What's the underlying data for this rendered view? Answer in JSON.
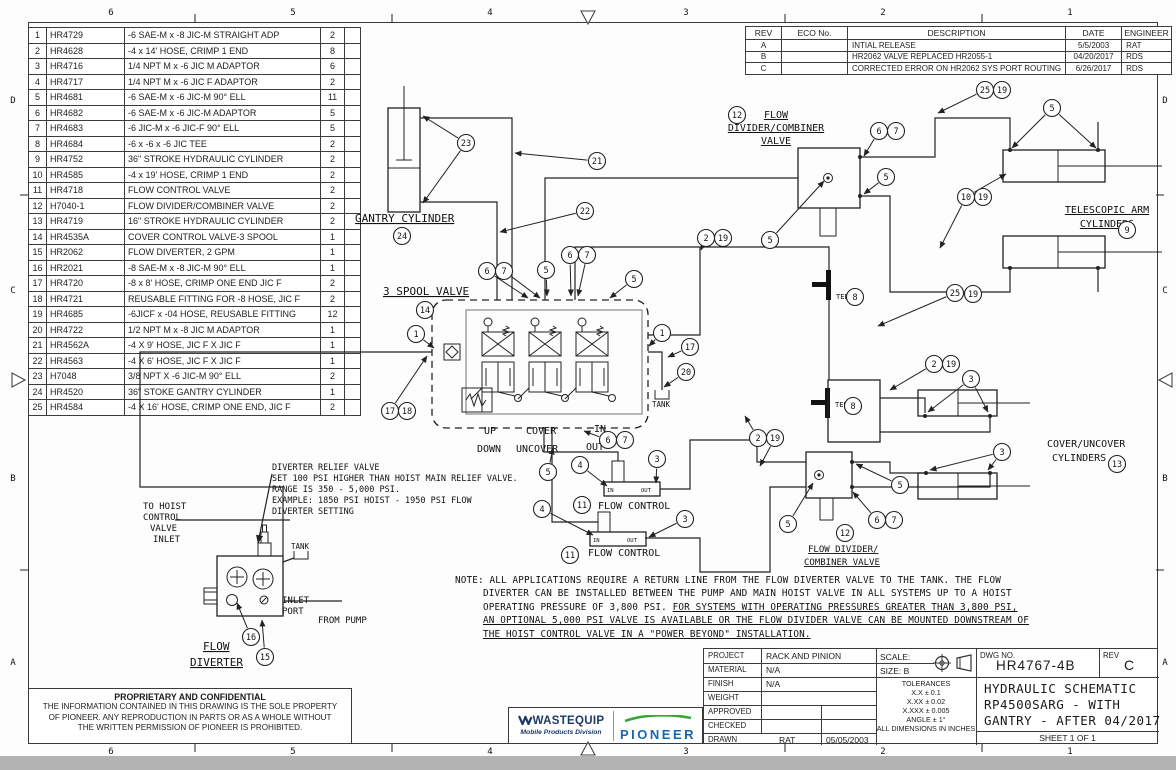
{
  "sheet": {
    "zones_top": [
      "6",
      "5",
      "4",
      "3",
      "2",
      "1"
    ],
    "zones_bottom": [
      "6",
      "5",
      "4",
      "3",
      "2",
      "1"
    ],
    "zones_left": [
      "D",
      "C",
      "B",
      "A"
    ],
    "zones_right": [
      "D",
      "C",
      "B",
      "A"
    ]
  },
  "parts_list": {
    "rows": [
      [
        "1",
        "HR4729",
        "-6 SAE-M x -8 JIC-M STRAIGHT ADP",
        "2"
      ],
      [
        "2",
        "HR4628",
        "-4 x 14' HOSE, CRIMP 1 END",
        "8"
      ],
      [
        "3",
        "HR4716",
        "1/4 NPT M x -6 JIC M ADAPTOR",
        "6"
      ],
      [
        "4",
        "HR4717",
        "1/4 NPT M x -6 JIC F ADAPTOR",
        "2"
      ],
      [
        "5",
        "HR4681",
        "-6 SAE-M x -6 JIC-M 90° ELL",
        "11"
      ],
      [
        "6",
        "HR4682",
        "-6 SAE-M x -6 JIC-M ADAPTOR",
        "5"
      ],
      [
        "7",
        "HR4683",
        "-6 JIC-M x -6 JIC-F 90° ELL",
        "5"
      ],
      [
        "8",
        "HR4684",
        "-6 x -6 x -6 JIC TEE",
        "2"
      ],
      [
        "9",
        "HR4752",
        "36\" STROKE HYDRAULIC CYLINDER",
        "2"
      ],
      [
        "10",
        "HR4585",
        "-4 x 19' HOSE, CRIMP 1 END",
        "2"
      ],
      [
        "11",
        "HR4718",
        "FLOW CONTROL VALVE",
        "2"
      ],
      [
        "12",
        "H7040-1",
        "FLOW DIVIDER/COMBINER VALVE",
        "2"
      ],
      [
        "13",
        "HR4719",
        "16\" STROKE HYDRAULIC CYLINDER",
        "2"
      ],
      [
        "14",
        "HR4535A",
        "COVER CONTROL VALVE-3 SPOOL",
        "1"
      ],
      [
        "15",
        "HR2062",
        "FLOW DIVERTER, 2 GPM",
        "1"
      ],
      [
        "16",
        "HR2021",
        "-8 SAE-M x -8 JIC-M 90° ELL",
        "1"
      ],
      [
        "17",
        "HR4720",
        "-8 x 8' HOSE, CRIMP ONE END JIC F",
        "2"
      ],
      [
        "18",
        "HR4721",
        "REUSABLE FITTING FOR -8 HOSE, JIC F",
        "2"
      ],
      [
        "19",
        "HR4685",
        "-6JICF x -04 HOSE, REUSABLE FITTING",
        "12"
      ],
      [
        "20",
        "HR4722",
        "1/2 NPT M x -8 JIC M ADAPTOR",
        "1"
      ],
      [
        "21",
        "HR4562A",
        "-4 X 9' HOSE, JIC F X JIC F",
        "1"
      ],
      [
        "22",
        "HR4563",
        "-4 X 6' HOSE, JIC F X JIC F",
        "1"
      ],
      [
        "23",
        "H7048",
        "3/8 NPT X -6 JIC-M 90° ELL",
        "2"
      ],
      [
        "24",
        "HR4520",
        "36\" STOKE GANTRY CYLINDER",
        "1"
      ],
      [
        "25",
        "HR4584",
        "-4 X 16' HOSE, CRIMP ONE END, JIC F",
        "2"
      ]
    ]
  },
  "revisions": {
    "headers": [
      "REV",
      "ECO No.",
      "DESCRIPTION",
      "DATE",
      "ENGINEER"
    ],
    "rows": [
      [
        "A",
        "",
        "INTIAL RELEASE",
        "5/5/2003",
        "RAT"
      ],
      [
        "B",
        "",
        "HR2062 VALVE REPLACED HR2055-1",
        "04/20/2017",
        "RDS"
      ],
      [
        "C",
        "",
        "CORRECTED ERROR ON HR2062 SYS PORT ROUTING",
        "6/26/2017",
        "RDS"
      ]
    ]
  },
  "title_block": {
    "project_label": "PROJECT",
    "project": "RACK AND PINION",
    "material_label": "MATERIAL",
    "material": "N/A",
    "finish_label": "FINISH",
    "finish": "N/A",
    "weight_label": "WEIGHT",
    "weight": "",
    "approved_label": "APPROVED",
    "approved": "",
    "checked_label": "CHECKED",
    "checked": "",
    "drawn_label": "DRAWN",
    "drawn": "RAT",
    "drawn_date": "05/05/2003",
    "scale": "SCALE:",
    "size": "SIZE: B",
    "tolerances": [
      "TOLERANCES",
      "X.X ± 0.1",
      "X.XX ± 0.02",
      "X.XXX ± 0.005",
      "ANGLE ± 1°",
      "ALL DIMENSIONS IN INCHES"
    ],
    "dwg_no_label": "DWG NO.",
    "dwg_no": "HR4767-4B",
    "rev_label": "REV",
    "rev": "C",
    "title_line1": "HYDRAULIC SCHEMATIC",
    "title_line2": "RP4500SARG - WITH",
    "title_line3": "GANTRY - AFTER 04/2017",
    "sheet": "SHEET 1  OF 1"
  },
  "proprietary": {
    "heading": "PROPRIETARY AND CONFIDENTIAL",
    "line1": "THE INFORMATION CONTAINED IN THIS DRAWING IS THE SOLE PROPERTY",
    "line2": "OF PIONEER.  ANY REPRODUCTION IN PARTS OR AS A WHOLE WITHOUT",
    "line3": "THE WRITTEN PERMISSION OF PIONEER IS PROHIBITED."
  },
  "logos": {
    "wastequip": "WASTEQUIP",
    "division": "Mobile Products Division",
    "pioneer": "PIONEER",
    "navy": "#1b3a66",
    "blue": "#1667b2",
    "green": "#3aa63a"
  },
  "note": {
    "line1": "NOTE:    ALL APPLICATIONS REQUIRE A RETURN LINE FROM THE FLOW DIVERTER VALVE TO THE TANK. THE FLOW",
    "line2": "DIVERTER CAN BE INSTALLED BETWEEN THE PUMP AND MAIN HOIST VALVE IN ALL SYSTEMS UP TO A HOIST",
    "line3a": "OPERATING PRESSURE OF 3,800 PSI. ",
    "line3b": "FOR SYSTEMS WITH OPERATING PRESSURES GREATER THAN 3,800 PSI,",
    "line4": "AN OPTIONAL 5,000 PSI VALVE IS AVAILABLE OR THE FLOW DIVIDER VALVE CAN BE MOUNTED DOWNSTREAM OF",
    "line5": "THE HOIST CONTROL VALVE IN A \"POWER BEYOND\" INSTALLATION."
  },
  "schematic": {
    "labels": [
      {
        "text": "GANTRY CYLINDER",
        "x": 355,
        "y": 222,
        "s": 11,
        "u": true
      },
      {
        "text": "3 SPOOL VALVE",
        "x": 383,
        "y": 295,
        "s": 11,
        "u": true
      },
      {
        "text": "FLOW",
        "x": 776,
        "y": 118,
        "s": 10,
        "a": "middle",
        "u": true
      },
      {
        "text": "DIVIDER/COMBINER",
        "x": 776,
        "y": 131,
        "s": 10,
        "a": "middle",
        "u": true
      },
      {
        "text": "VALVE",
        "x": 776,
        "y": 144,
        "s": 10,
        "a": "middle",
        "u": true
      },
      {
        "text": "TELESCOPIC ARM",
        "x": 1107,
        "y": 213,
        "s": 10,
        "a": "middle",
        "u": true
      },
      {
        "text": "CYLINDERS",
        "x": 1107,
        "y": 227,
        "s": 10,
        "a": "middle",
        "u": true
      },
      {
        "text": "COVER/UNCOVER",
        "x": 1047,
        "y": 447,
        "s": 10
      },
      {
        "text": "CYLINDERS",
        "x": 1052,
        "y": 461,
        "s": 10
      },
      {
        "text": "FLOW DIVIDER/",
        "x": 808,
        "y": 552,
        "s": 9,
        "u": true
      },
      {
        "text": "COMBINER VALVE",
        "x": 804,
        "y": 565,
        "s": 9,
        "u": true
      },
      {
        "text": "FLOW CONTROL",
        "x": 598,
        "y": 509,
        "s": 10
      },
      {
        "text": "FLOW CONTROL",
        "x": 588,
        "y": 556,
        "s": 10
      },
      {
        "text": "UP",
        "x": 484,
        "y": 434,
        "s": 10
      },
      {
        "text": "DOWN",
        "x": 477,
        "y": 452,
        "s": 10
      },
      {
        "text": "COVER",
        "x": 526,
        "y": 434,
        "s": 10
      },
      {
        "text": "UNCOVER",
        "x": 516,
        "y": 452,
        "s": 10
      },
      {
        "text": "IN",
        "x": 594,
        "y": 432,
        "s": 10
      },
      {
        "text": "OUT",
        "x": 586,
        "y": 450,
        "s": 10
      },
      {
        "text": "TANK",
        "x": 652,
        "y": 407,
        "s": 7.5
      },
      {
        "text": "TANK",
        "x": 291,
        "y": 549,
        "s": 7.5
      },
      {
        "text": "TEE",
        "x": 836,
        "y": 299,
        "s": 7
      },
      {
        "text": "TEE",
        "x": 835,
        "y": 407,
        "s": 7
      },
      {
        "text": "TO HOIST",
        "x": 143,
        "y": 509,
        "s": 9
      },
      {
        "text": "CONTROL",
        "x": 143,
        "y": 520,
        "s": 9
      },
      {
        "text": "VALVE",
        "x": 150,
        "y": 531,
        "s": 9
      },
      {
        "text": "INLET",
        "x": 153,
        "y": 542,
        "s": 9
      },
      {
        "text": "DIVERTER RELIEF VALVE",
        "x": 272,
        "y": 470,
        "s": 8.5
      },
      {
        "text": "SET 100 PSI HIGHER THAN HOIST MAIN RELIEF VALVE.",
        "x": 272,
        "y": 481,
        "s": 8.5
      },
      {
        "text": "RANGE IS 350 - 5,000 PSI.",
        "x": 272,
        "y": 492,
        "s": 8.5
      },
      {
        "text": "EXAMPLE: 1850 PSI HOIST - 1950 PSI FLOW",
        "x": 272,
        "y": 503,
        "s": 8.5
      },
      {
        "text": "DIVERTER SETTING",
        "x": 272,
        "y": 514,
        "s": 8.5
      },
      {
        "text": "INLET",
        "x": 282,
        "y": 603,
        "s": 9
      },
      {
        "text": "PORT",
        "x": 282,
        "y": 614,
        "s": 9
      },
      {
        "text": "FROM PUMP",
        "x": 318,
        "y": 623,
        "s": 9
      },
      {
        "text": "FLOW",
        "x": 203,
        "y": 650,
        "s": 11,
        "u": true
      },
      {
        "text": "DIVERTER",
        "x": 190,
        "y": 666,
        "s": 11,
        "u": true
      },
      {
        "text": "IN",
        "x": 607,
        "y": 492,
        "s": 5.5
      },
      {
        "text": "OUT",
        "x": 641,
        "y": 492,
        "s": 5.5
      },
      {
        "text": "IN",
        "x": 593,
        "y": 542,
        "s": 5.5
      },
      {
        "text": "OUT",
        "x": 627,
        "y": 542,
        "s": 5.5
      }
    ],
    "balloons": [
      {
        "n": "23",
        "x": 466,
        "y": 143,
        "t": [
          [
            423,
            116
          ],
          [
            423,
            203
          ]
        ]
      },
      {
        "n": "21",
        "x": 597,
        "y": 161,
        "t": [
          [
            515,
            153
          ]
        ]
      },
      {
        "n": "24",
        "x": 402,
        "y": 236
      },
      {
        "n": "22",
        "x": 585,
        "y": 211,
        "t": [
          [
            500,
            232
          ]
        ]
      },
      {
        "n": "14",
        "x": 425,
        "y": 310
      },
      {
        "n": "1",
        "x": 416,
        "y": 334,
        "t": [
          [
            434,
            348
          ]
        ]
      },
      {
        "n": "1",
        "x": 662,
        "y": 333,
        "t": [
          [
            649,
            346
          ]
        ]
      },
      {
        "n": "6",
        "x": 487,
        "y": 271,
        "t": [
          [
            528,
            298
          ]
        ]
      },
      {
        "n": "7",
        "x": 504,
        "y": 271,
        "t": [
          [
            540,
            298
          ]
        ]
      },
      {
        "n": "5",
        "x": 546,
        "y": 270,
        "t": [
          [
            547,
            296
          ]
        ]
      },
      {
        "n": "6",
        "x": 570,
        "y": 255,
        "t": [
          [
            571,
            296
          ]
        ]
      },
      {
        "n": "7",
        "x": 587,
        "y": 255,
        "t": [
          [
            578,
            296
          ]
        ]
      },
      {
        "n": "5",
        "x": 634,
        "y": 279,
        "t": [
          [
            610,
            298
          ]
        ]
      },
      {
        "n": "2",
        "x": 706,
        "y": 238,
        "t": [
          [
            701,
            250
          ]
        ]
      },
      {
        "n": "19",
        "x": 723,
        "y": 238
      },
      {
        "n": "17",
        "x": 690,
        "y": 347,
        "t": [
          [
            668,
            357
          ]
        ]
      },
      {
        "n": "20",
        "x": 686,
        "y": 372,
        "t": [
          [
            664,
            387
          ]
        ]
      },
      {
        "n": "17",
        "x": 390,
        "y": 411,
        "t": [
          [
            427,
            356
          ]
        ]
      },
      {
        "n": "18",
        "x": 407,
        "y": 411
      },
      {
        "n": "12",
        "x": 737,
        "y": 115
      },
      {
        "n": "6",
        "x": 879,
        "y": 131,
        "t": [
          [
            864,
            156
          ]
        ]
      },
      {
        "n": "7",
        "x": 896,
        "y": 131
      },
      {
        "n": "5",
        "x": 886,
        "y": 177,
        "t": [
          [
            864,
            194
          ]
        ]
      },
      {
        "n": "5",
        "x": 770,
        "y": 240,
        "t": [
          [
            824,
            181
          ]
        ]
      },
      {
        "n": "25",
        "x": 985,
        "y": 90,
        "t": [
          [
            938,
            113
          ]
        ]
      },
      {
        "n": "19",
        "x": 1002,
        "y": 90
      },
      {
        "n": "5",
        "x": 1052,
        "y": 108,
        "t": [
          [
            1012,
            148
          ],
          [
            1096,
            148
          ]
        ]
      },
      {
        "n": "10",
        "x": 966,
        "y": 197,
        "t": [
          [
            1006,
            174
          ],
          [
            940,
            248
          ]
        ]
      },
      {
        "n": "19",
        "x": 983,
        "y": 197
      },
      {
        "n": "9",
        "x": 1127,
        "y": 230
      },
      {
        "n": "25",
        "x": 955,
        "y": 293,
        "t": [
          [
            878,
            326
          ]
        ]
      },
      {
        "n": "19",
        "x": 973,
        "y": 294
      },
      {
        "n": "8",
        "x": 855,
        "y": 297
      },
      {
        "n": "8",
        "x": 853,
        "y": 406
      },
      {
        "n": "2",
        "x": 934,
        "y": 364,
        "t": [
          [
            890,
            390
          ]
        ]
      },
      {
        "n": "19",
        "x": 951,
        "y": 364
      },
      {
        "n": "3",
        "x": 971,
        "y": 379,
        "t": [
          [
            928,
            412
          ],
          [
            988,
            412
          ]
        ]
      },
      {
        "n": "3",
        "x": 1002,
        "y": 452,
        "t": [
          [
            930,
            470
          ],
          [
            988,
            470
          ]
        ]
      },
      {
        "n": "13",
        "x": 1117,
        "y": 464
      },
      {
        "n": "2",
        "x": 758,
        "y": 438,
        "t": [
          [
            745,
            416
          ]
        ]
      },
      {
        "n": "19",
        "x": 775,
        "y": 438,
        "t": [
          [
            760,
            466
          ]
        ]
      },
      {
        "n": "5",
        "x": 900,
        "y": 485,
        "t": [
          [
            856,
            464
          ]
        ]
      },
      {
        "n": "5",
        "x": 788,
        "y": 524,
        "t": [
          [
            813,
            483
          ]
        ]
      },
      {
        "n": "6",
        "x": 877,
        "y": 520,
        "t": [
          [
            853,
            492
          ]
        ]
      },
      {
        "n": "7",
        "x": 894,
        "y": 520
      },
      {
        "n": "12",
        "x": 845,
        "y": 533
      },
      {
        "n": "4",
        "x": 580,
        "y": 465,
        "t": [
          [
            607,
            486
          ]
        ]
      },
      {
        "n": "3",
        "x": 657,
        "y": 459,
        "t": [
          [
            656,
            483
          ]
        ]
      },
      {
        "n": "11",
        "x": 582,
        "y": 505
      },
      {
        "n": "4",
        "x": 542,
        "y": 509,
        "t": [
          [
            593,
            535
          ]
        ]
      },
      {
        "n": "3",
        "x": 685,
        "y": 519,
        "t": [
          [
            649,
            537
          ]
        ]
      },
      {
        "n": "11",
        "x": 570,
        "y": 555
      },
      {
        "n": "5",
        "x": 548,
        "y": 472,
        "t": [
          [
            553,
            448
          ]
        ]
      },
      {
        "n": "6",
        "x": 608,
        "y": 440,
        "t": [
          [
            584,
            431
          ]
        ]
      },
      {
        "n": "7",
        "x": 625,
        "y": 440
      },
      {
        "n": "16",
        "x": 251,
        "y": 637,
        "t": [
          [
            237,
            603
          ]
        ]
      },
      {
        "n": "15",
        "x": 265,
        "y": 657,
        "t": [
          [
            262,
            620
          ]
        ]
      }
    ]
  }
}
